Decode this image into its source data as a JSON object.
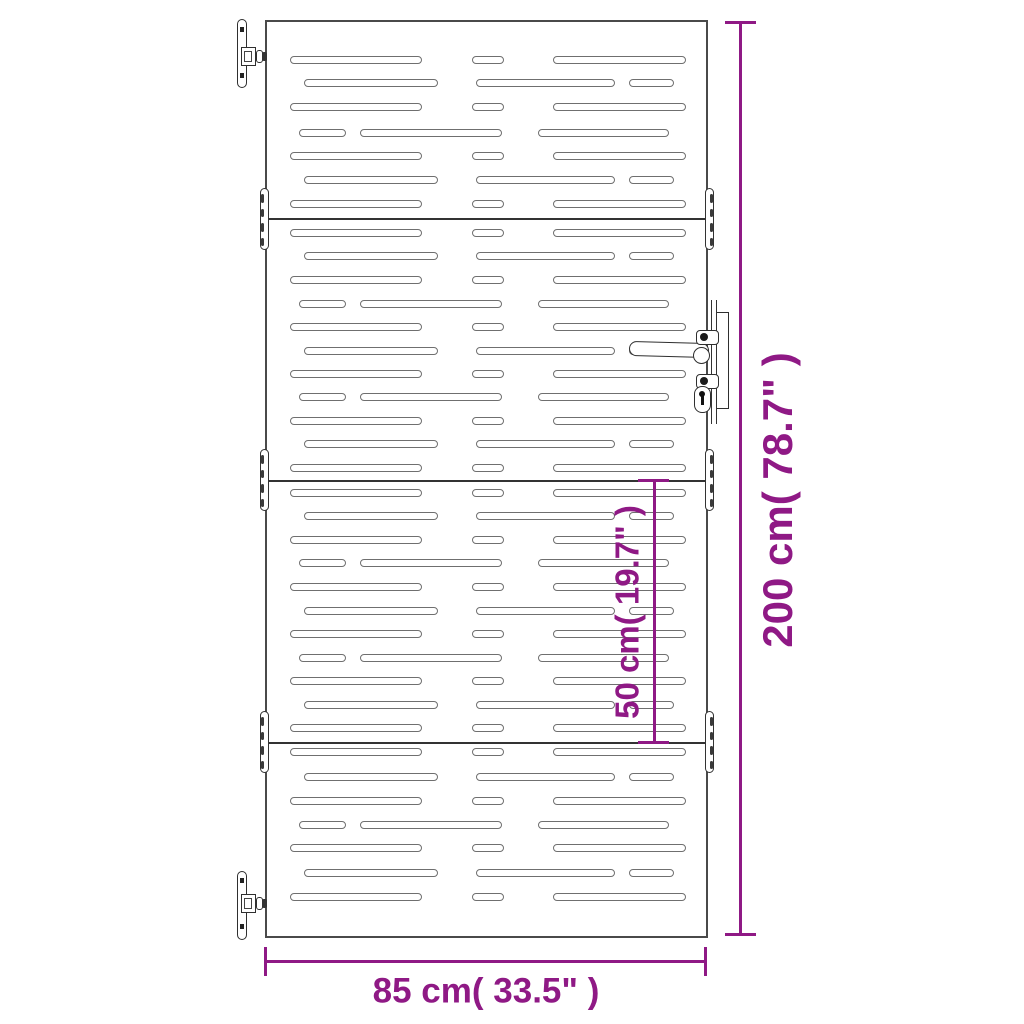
{
  "title": "Garden gate dimension diagram",
  "colors": {
    "dimension": "#8f1985",
    "gate_outline": "#4a4a4a",
    "slot_outline": "#6f6f6f",
    "hardware_dark": "#1e1e1e",
    "background": "#ffffff"
  },
  "dimensions": {
    "height": {
      "label": "200 cm( 78.7\" )"
    },
    "section": {
      "label": "50 cm( 19.7\" )"
    },
    "width": {
      "label": "85 cm( 33.5\" )"
    }
  },
  "gate": {
    "frame": {
      "left": 265,
      "top": 20,
      "width": 443,
      "height": 918
    },
    "joints": [
      218,
      480,
      742
    ],
    "slot_height": 8,
    "slot_patterns": {
      "A": [
        [
          290,
          132
        ],
        [
          472,
          32
        ],
        [
          553,
          133
        ]
      ],
      "B": [
        [
          304,
          134
        ],
        [
          476,
          139
        ],
        [
          629,
          45
        ]
      ],
      "C": [
        [
          299,
          47
        ],
        [
          360,
          142
        ],
        [
          538,
          131
        ]
      ]
    },
    "slot_rows": [
      {
        "y": 60,
        "p": "A"
      },
      {
        "y": 83,
        "p": "B"
      },
      {
        "y": 107,
        "p": "A"
      },
      {
        "y": 133,
        "p": "C"
      },
      {
        "y": 156,
        "p": "A"
      },
      {
        "y": 180,
        "p": "B"
      },
      {
        "y": 204,
        "p": "A"
      },
      {
        "y": 233,
        "p": "A"
      },
      {
        "y": 256,
        "p": "B"
      },
      {
        "y": 280,
        "p": "A"
      },
      {
        "y": 304,
        "p": "C"
      },
      {
        "y": 327,
        "p": "A"
      },
      {
        "y": 351,
        "p": "B"
      },
      {
        "y": 374,
        "p": "A"
      },
      {
        "y": 397,
        "p": "C"
      },
      {
        "y": 421,
        "p": "A"
      },
      {
        "y": 444,
        "p": "B"
      },
      {
        "y": 468,
        "p": "A"
      },
      {
        "y": 493,
        "p": "A"
      },
      {
        "y": 516,
        "p": "B"
      },
      {
        "y": 540,
        "p": "A"
      },
      {
        "y": 563,
        "p": "C"
      },
      {
        "y": 587,
        "p": "A"
      },
      {
        "y": 611,
        "p": "B"
      },
      {
        "y": 634,
        "p": "A"
      },
      {
        "y": 658,
        "p": "C"
      },
      {
        "y": 681,
        "p": "A"
      },
      {
        "y": 705,
        "p": "B"
      },
      {
        "y": 728,
        "p": "A"
      },
      {
        "y": 752,
        "p": "A"
      },
      {
        "y": 777,
        "p": "B"
      },
      {
        "y": 801,
        "p": "A"
      },
      {
        "y": 825,
        "p": "C"
      },
      {
        "y": 848,
        "p": "A"
      },
      {
        "y": 873,
        "p": "B"
      },
      {
        "y": 897,
        "p": "A"
      }
    ],
    "hinge_capsules": [
      {
        "joint": 219,
        "side": "left"
      },
      {
        "joint": 219,
        "side": "right"
      },
      {
        "joint": 480,
        "side": "left"
      },
      {
        "joint": 480,
        "side": "right"
      },
      {
        "joint": 742,
        "side": "left"
      },
      {
        "joint": 742,
        "side": "right"
      }
    ]
  }
}
